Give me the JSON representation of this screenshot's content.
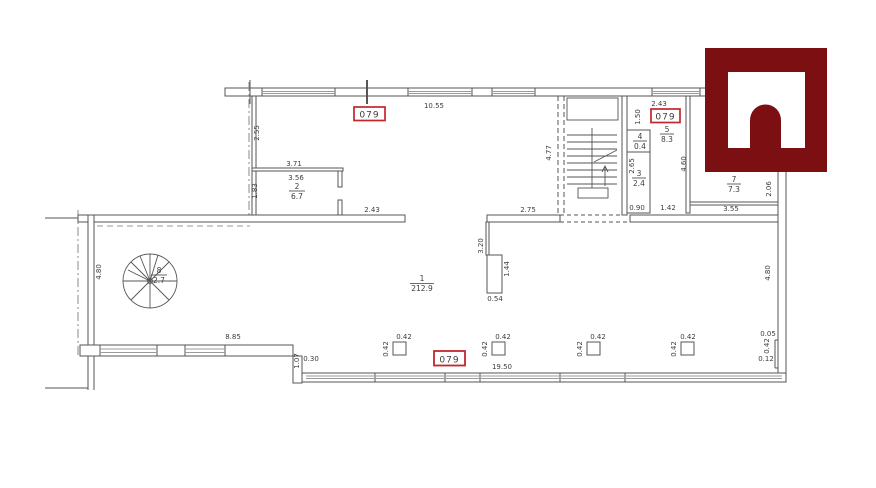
{
  "drawing": {
    "type": "architectural floor plan (scanned)",
    "unit_badges": [
      "079",
      "079",
      "079"
    ],
    "rooms": [
      {
        "number": "1",
        "area": "212.9"
      },
      {
        "number": "2",
        "area": "6.7"
      },
      {
        "number": "3",
        "area": "2.4"
      },
      {
        "number": "4",
        "area": "0.4"
      },
      {
        "number": "5",
        "area": "8.3"
      },
      {
        "number": "7",
        "area": "7.3"
      },
      {
        "number": "8",
        "area": "2.7"
      }
    ],
    "dims_h": [
      "10.55",
      "3.71",
      "3.56",
      "2.43",
      "2.75",
      "2.43",
      "0.90",
      "1.42",
      "3.55",
      "8.85",
      "0.30",
      "19.50",
      "0.54",
      "0.05",
      "0.12",
      "0.42",
      "0.42",
      "0.42",
      "0.42"
    ],
    "dims_v": [
      "2.55",
      "1.83",
      "4.77",
      "1.50",
      "2.65",
      "4.60",
      "2.06",
      "4.80",
      "4.80",
      "3.20",
      "1.44",
      "1.07",
      "0.42",
      "0.42",
      "0.42",
      "0.42",
      "0.42"
    ]
  },
  "colors": {
    "line": "#565656",
    "window_line": "#9b9b9b",
    "badge_red": "#c1272d",
    "logo_maroon": "#7c0f12"
  }
}
